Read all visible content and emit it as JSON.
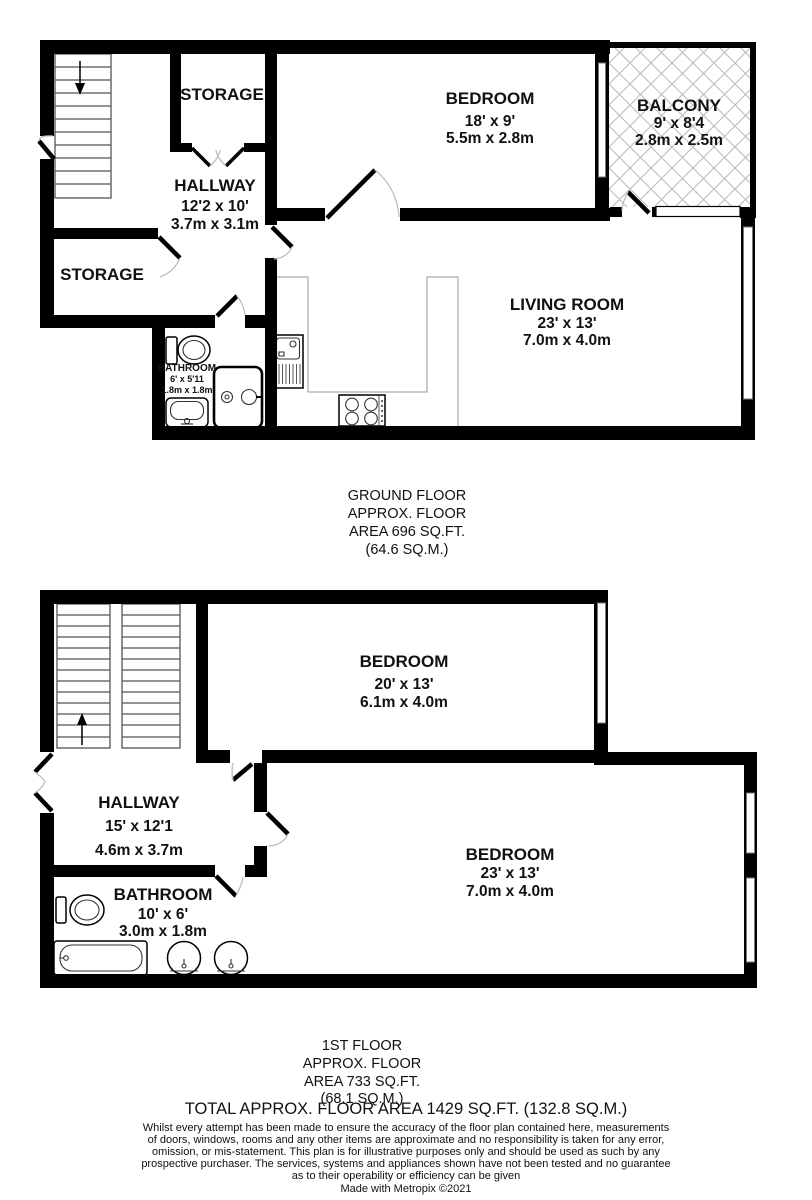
{
  "ground_floor": {
    "rooms": {
      "storage_top": {
        "name": "STORAGE"
      },
      "bedroom": {
        "name": "BEDROOM",
        "size_imperial": "18' x 9'",
        "size_metric": "5.5m x 2.8m"
      },
      "balcony": {
        "name": "BALCONY",
        "size_imperial": "9' x 8'4",
        "size_metric": "2.8m x 2.5m"
      },
      "hallway": {
        "name": "HALLWAY",
        "size_imperial": "12'2 x 10'",
        "size_metric": "3.7m x 3.1m"
      },
      "storage_lower": {
        "name": "STORAGE"
      },
      "bathroom": {
        "name": "BATHROOM",
        "size_imperial": "6' x 5'11",
        "size_metric": "1.8m x 1.8m"
      },
      "living_room": {
        "name": "LIVING ROOM",
        "size_imperial": "23' x 13'",
        "size_metric": "7.0m x 4.0m"
      }
    },
    "caption": [
      "GROUND FLOOR",
      "APPROX. FLOOR",
      "AREA 696 SQ.FT.",
      "(64.6 SQ.M.)"
    ]
  },
  "first_floor": {
    "rooms": {
      "bedroom_rear": {
        "name": "BEDROOM",
        "size_imperial": "20' x 13'",
        "size_metric": "6.1m x 4.0m"
      },
      "hallway": {
        "name": "HALLWAY",
        "size_imperial": "15' x 12'1",
        "size_metric": "4.6m x 3.7m"
      },
      "bathroom": {
        "name": "BATHROOM",
        "size_imperial": "10' x 6'",
        "size_metric": "3.0m x 1.8m"
      },
      "bedroom_front": {
        "name": "BEDROOM",
        "size_imperial": "23' x 13'",
        "size_metric": "7.0m x 4.0m"
      }
    },
    "caption": [
      "1ST FLOOR",
      "APPROX. FLOOR",
      "AREA 733 SQ.FT.",
      "(68.1 SQ.M.)"
    ]
  },
  "footer": {
    "total": "TOTAL APPROX. FLOOR AREA 1429 SQ.FT. (132.8 SQ.M.)",
    "disclaimer": [
      "Whilst every attempt has been made to ensure the accuracy of the floor plan contained here, measurements",
      "of doors, windows, rooms and any other items are approximate and no responsibility is taken for any error,",
      "omission, or mis-statement. This plan is for illustrative purposes only and should be used as such by any",
      "prospective purchaser. The services, systems and appliances shown have not been tested and no guarantee",
      "as to their operability or efficiency can be given"
    ],
    "credit": "Made with Metropix ©2021"
  },
  "colors": {
    "walls": "#000000",
    "background": "#ffffff",
    "balcony_hatch": "#bcbcbc",
    "door_arc": "#bdbdbd",
    "stair_line": "#555555",
    "counter_line": "#aaaaaa"
  }
}
